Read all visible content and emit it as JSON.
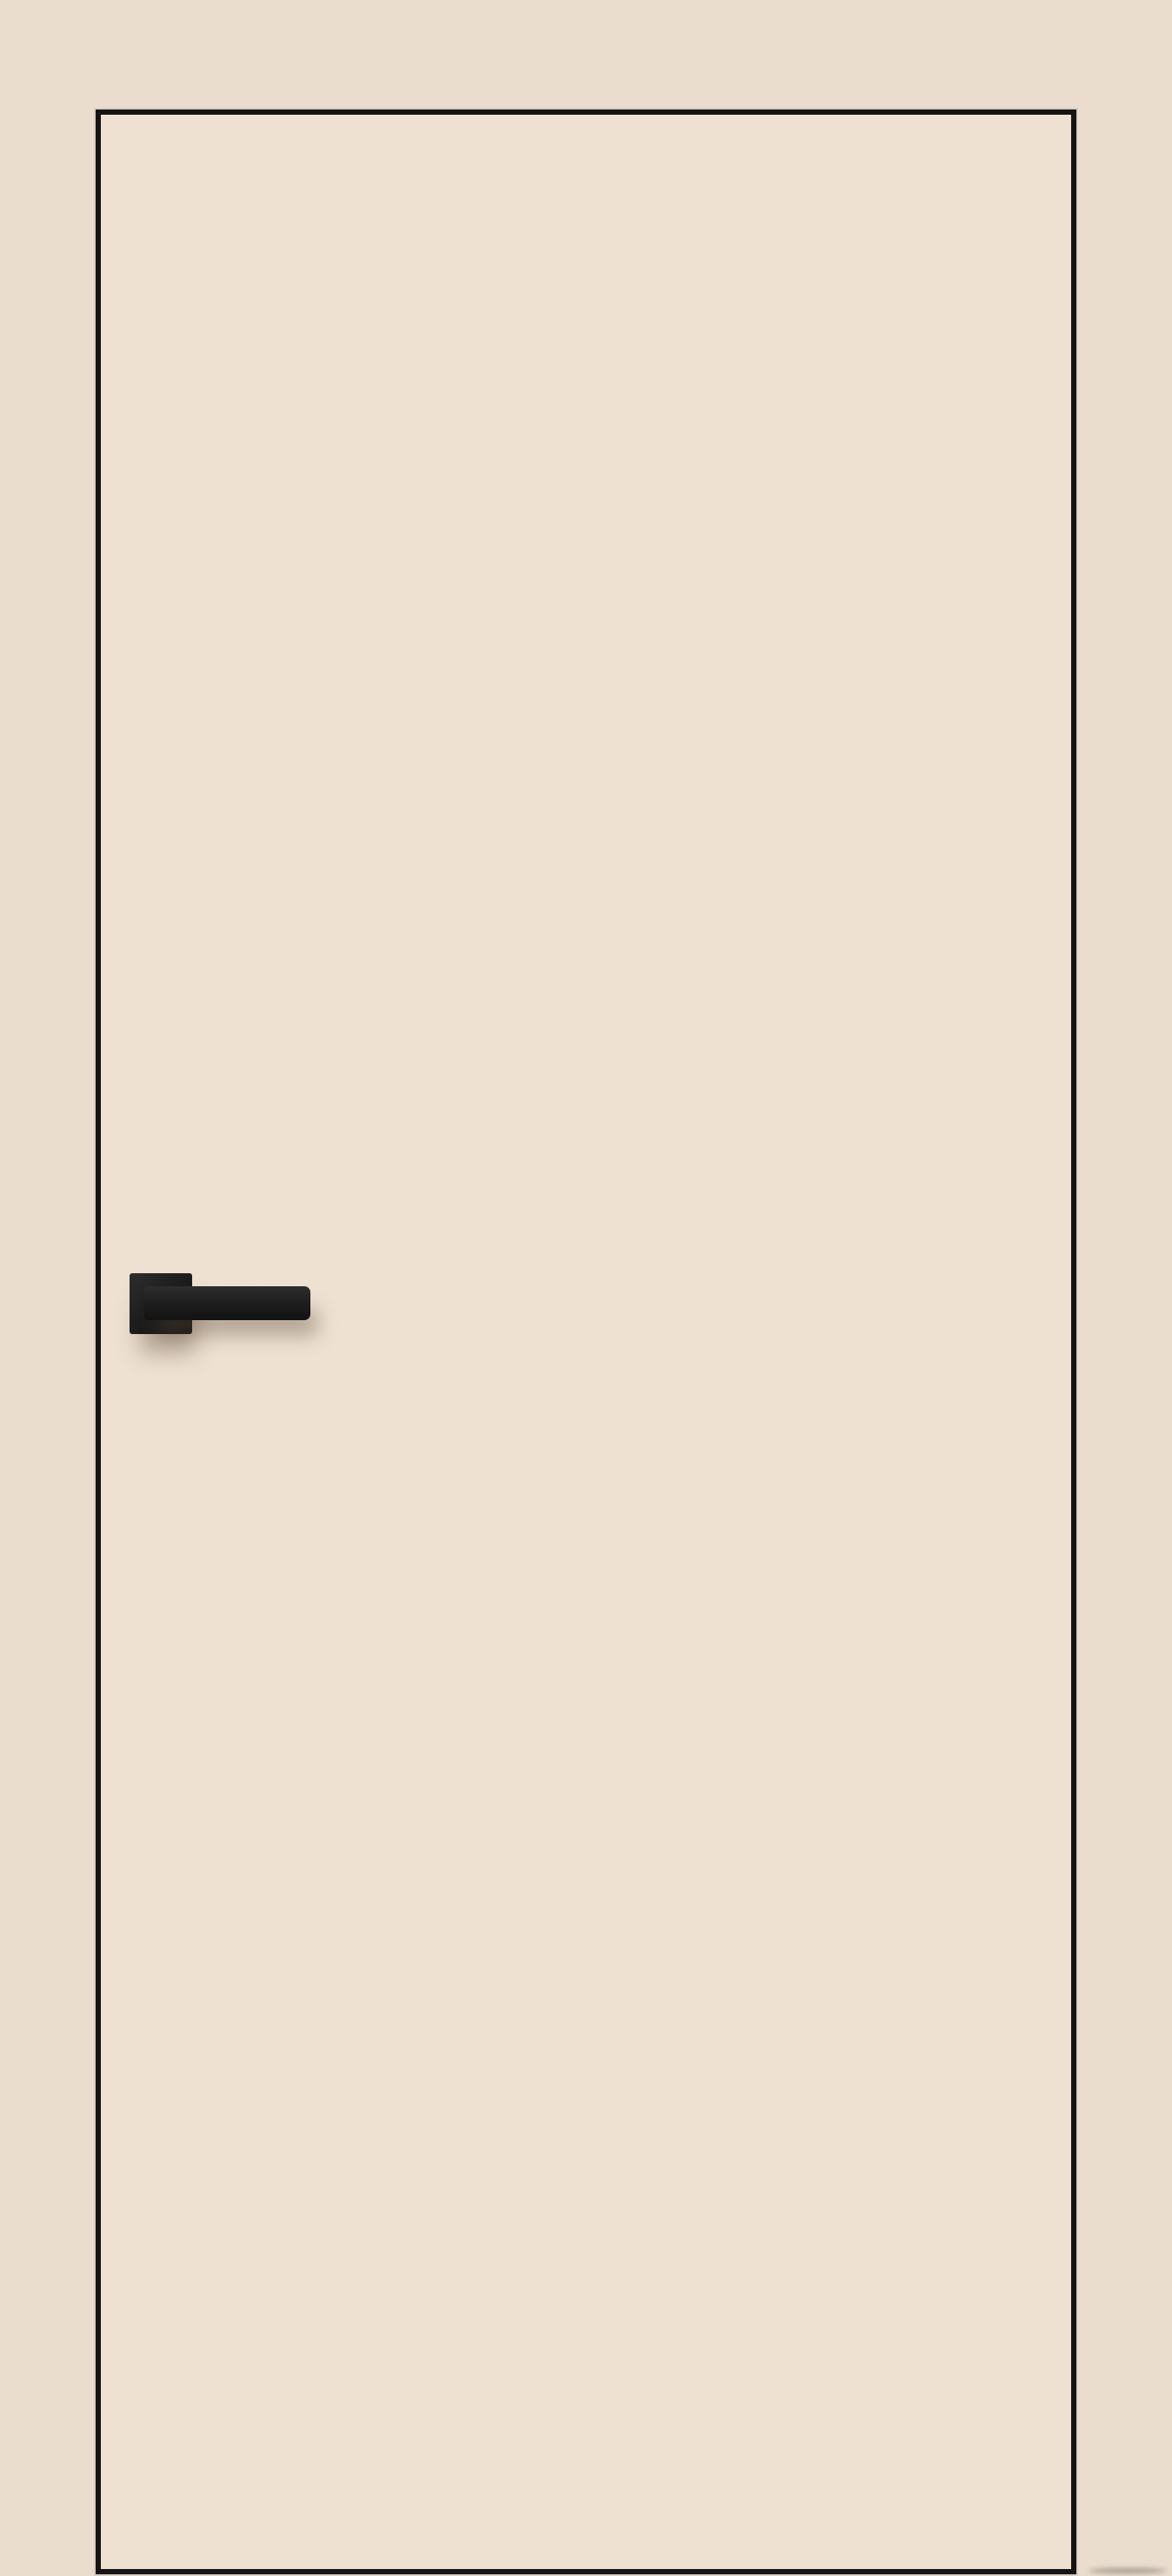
{
  "scene": {
    "type": "product-photo",
    "subject": "Beige interior flush door with thin black edge trim and matte black lever handle on a square rosette, set against a matching beige wall",
    "objects": {
      "wall": {
        "label": "plain beige wall background"
      },
      "door": {
        "label": "flush beige door panel outlined with thin black edge trim"
      },
      "handle": {
        "label": "matte black door handle",
        "parts": {
          "rosette": "square black rosette plate",
          "lever": "straight rectangular black lever pointing right"
        }
      },
      "floor_shadow": {
        "label": "faint shadow streak on floor at lower right of door"
      }
    }
  },
  "colors": {
    "wall": "#EADDCE",
    "door_face": "#EEE1D2",
    "door_edge": "#141414",
    "edge_highlight": "#D8CDC1",
    "handle": "#1F1F1F",
    "lever_hi": "#2E2E2E",
    "lever_lo": "#121212",
    "handle_shadow": "rgba(96,74,58,0.40)",
    "floor_shadow": "rgba(110,100,92,0.55)"
  }
}
